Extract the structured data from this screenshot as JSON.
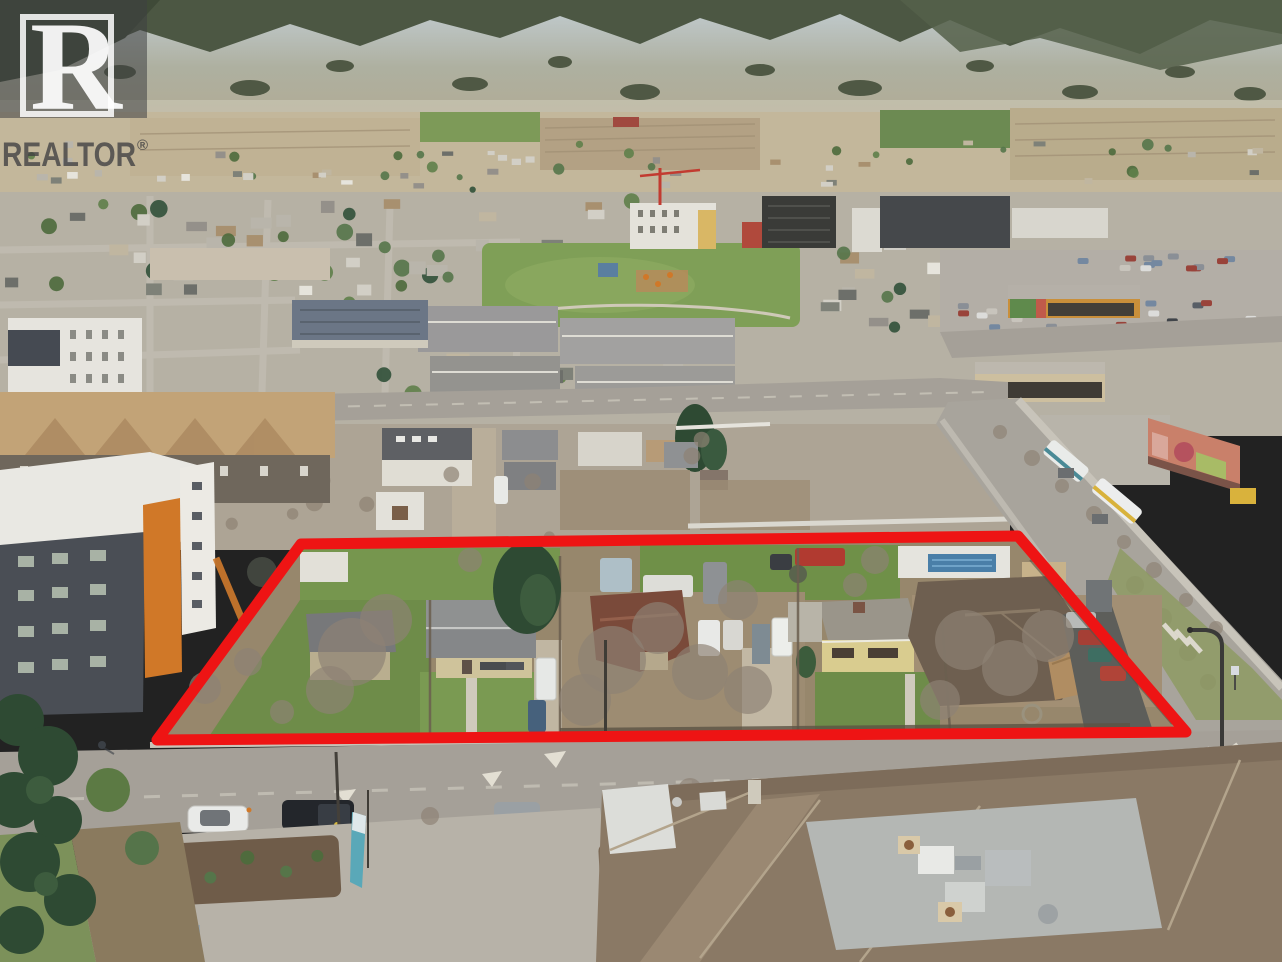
{
  "scene_description": "Aerial drone photograph of a valley town: forested mountains and farm fields behind, dense residential and commercial blocks in the middle, and a large multi-lot residential development parcel outlined in red beside a transit street, with a wide road, parking lots and large shingle-roof commercial building in the foreground.",
  "watermark": {
    "symbol_letter": "R",
    "label": "REALTOR",
    "registered_mark": "®",
    "tile_color": "#3e4042",
    "tile_opacity": "0.55",
    "frame_color": "#ffffff",
    "frame_opacity": "0.85",
    "letter_color": "#ffffff",
    "letter_opacity": "0.92",
    "wordmark_color": "#3f3f41",
    "wordmark_opacity": "0.78"
  },
  "property_outline": {
    "color": "#ee1414",
    "stroke_width": "11",
    "points": "301,544 1018,536 1186,732 157,740"
  },
  "palette": {
    "mountain_forest": "#4c5743",
    "mountain_slope": "#b3a88e",
    "valley_field": "#c3b79b",
    "field_green": "#7d9a58",
    "urban_ground": "#b6b1a4",
    "road": "#a5a098",
    "concrete": "#c9c4b8",
    "lawn": "#6f8c4a",
    "dirt": "#9c8a70",
    "tree_green": "#4c6a3c",
    "conifer": "#2e4a33",
    "tree_bare": "#8d8274",
    "roof_white": "#e8e6e0",
    "roof_gray": "#8f9191",
    "roof_dark": "#55565a",
    "roof_brown": "#6e5f50",
    "roof_tan": "#c2a377",
    "house_yellow": "#d9cc8f",
    "accent_orange": "#d07828",
    "pool_blue": "#4a7fa8",
    "mural_salmon": "#c9806a",
    "banner_teal": "#57a8b5"
  }
}
